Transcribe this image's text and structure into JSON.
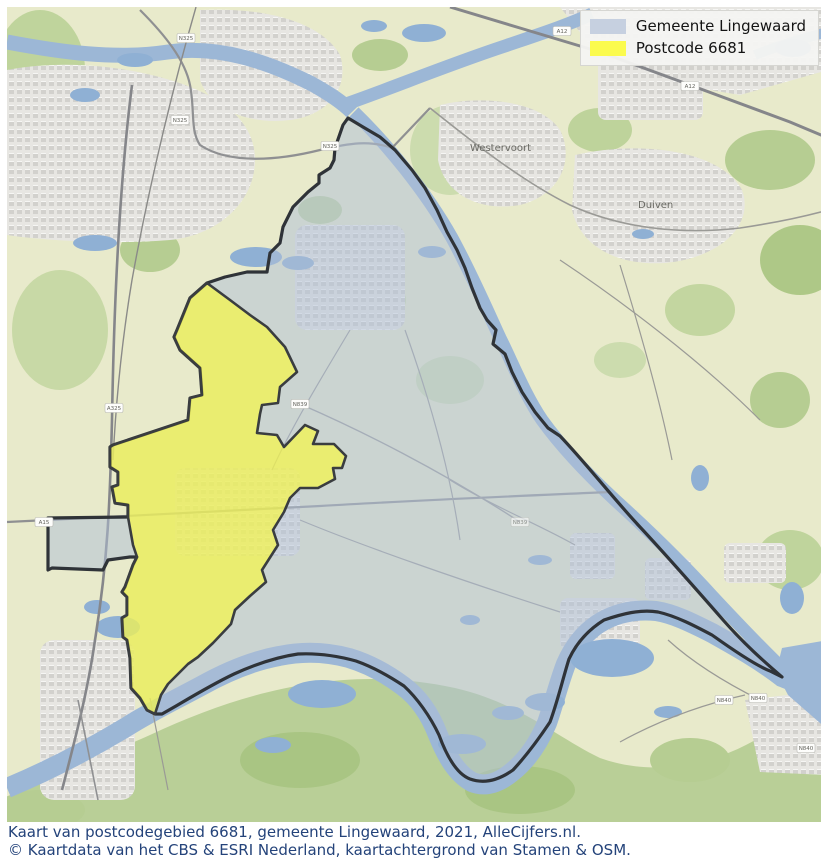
{
  "legend": {
    "items": [
      {
        "label": "Gemeente Lingewaard",
        "color": "#c6d0e0"
      },
      {
        "label": "Postcode 6681",
        "color": "#fbfb4e"
      }
    ]
  },
  "caption": {
    "line1": "Kaart van postcodegebied 6681, gemeente Lingewaard, 2021, AlleCijfers.nl.",
    "line2": "© Kaartdata van het CBS & ESRI Nederland, kaartachtergrond van Stamen & OSM."
  },
  "map": {
    "town_labels": [
      {
        "name": "Westervoort"
      },
      {
        "name": "Duiven"
      }
    ],
    "road_shields": [
      {
        "label": "N325"
      },
      {
        "label": "N325"
      },
      {
        "label": "N325"
      },
      {
        "label": "A325"
      },
      {
        "label": "A12"
      },
      {
        "label": "A12"
      },
      {
        "label": "A15"
      },
      {
        "label": "N839"
      },
      {
        "label": "N839"
      },
      {
        "label": "N840"
      },
      {
        "label": "N840"
      },
      {
        "label": "N840"
      }
    ],
    "colors": {
      "municipality_fill": "rgba(176,192,214,0.52)",
      "municipality_stroke": "#2f3338",
      "postcode_fill": "rgba(250,250,60,0.65)",
      "postcode_stroke": "#3a3d40",
      "legend_swatch_municipality": "#c6d0e0",
      "legend_swatch_postcode": "#fbfb4e",
      "water": "#9cb7d6",
      "field": "#e8eacb",
      "woodland": "#aec887",
      "urban": "#e7e6e2",
      "road": "#9a9a96",
      "caption_text": "#24437a"
    }
  }
}
